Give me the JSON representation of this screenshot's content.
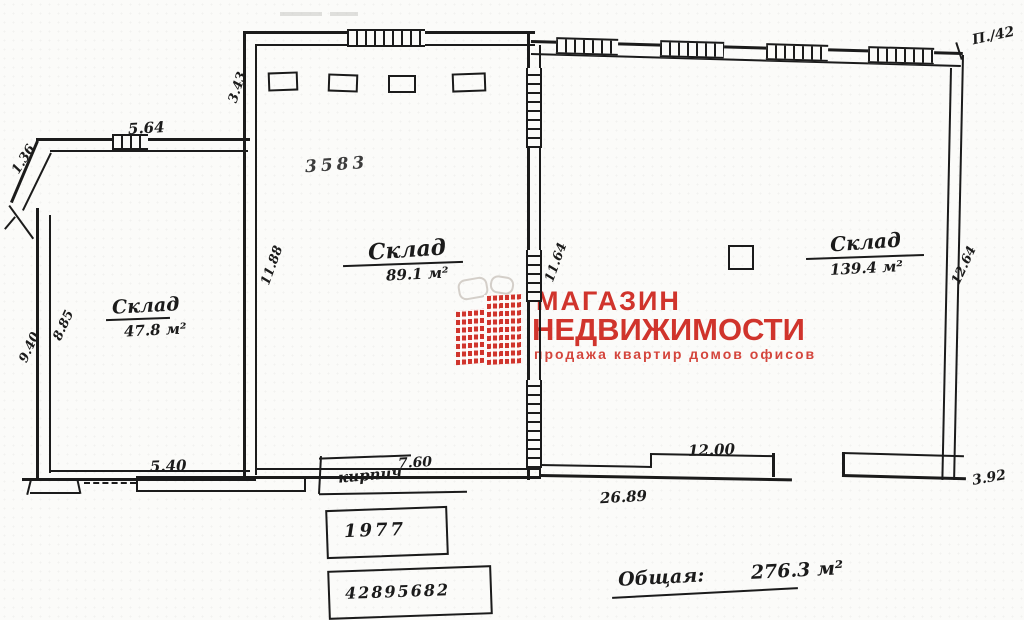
{
  "logo": {
    "line1": "МАГАЗИН",
    "line2": "НЕДВИЖИМОСТИ",
    "tagline": "продажа  квартир  домов  офисов"
  },
  "rooms": [
    {
      "name": "Склад",
      "area": "47.8 м²"
    },
    {
      "name": "Склад",
      "area": "89.1 м²"
    },
    {
      "name": "Склад",
      "area": "139.4 м²"
    }
  ],
  "total": {
    "label": "Общая:",
    "value": "276.3 м²"
  },
  "dims": {
    "d564": "5.64",
    "d136": "1.36",
    "d343": "3.43",
    "d940": "9.40",
    "d885": "8.85",
    "d1188": "11.88",
    "d1164": "11.64",
    "d1264": "12.64",
    "d540": "5.40",
    "d760": "7.60",
    "d1200": "12.00",
    "d2689": "26.89",
    "d392": "3.92"
  },
  "stamps": {
    "plan_number": "3583",
    "year": "1977",
    "inventory": "42895682",
    "corner_note": "П./42"
  },
  "notes": {
    "material": "кирпич"
  },
  "colors": {
    "ink": "#1b1b1b",
    "logo_red": "#d0342c",
    "paper": "#fbfbf9"
  }
}
